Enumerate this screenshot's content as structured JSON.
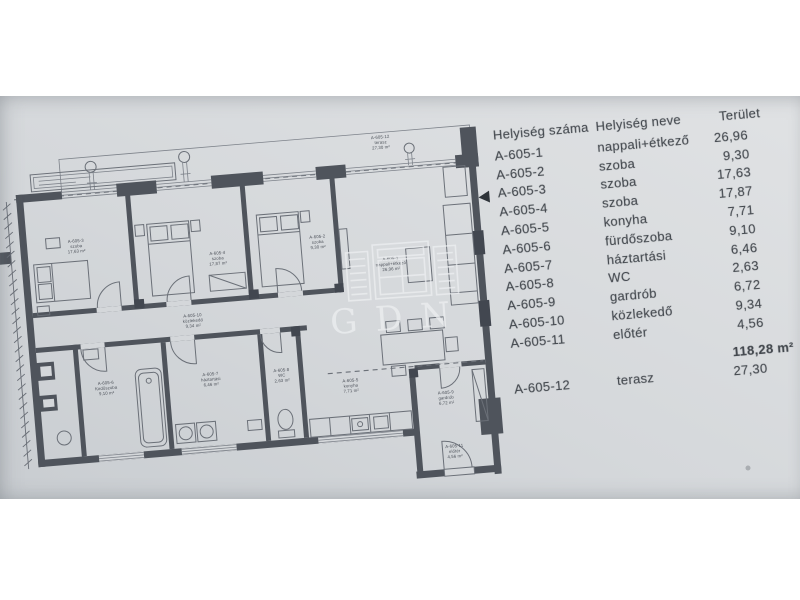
{
  "watermark": {
    "text": "GDN"
  },
  "colors": {
    "paper": "#d4d7da",
    "wall": "#4f545c",
    "line": "#6f747b",
    "text": "#42474d",
    "watermark": "#eef0f2"
  },
  "table": {
    "headers": {
      "number": "Helyiség száma",
      "name": "Helyiség neve",
      "area": "Terület"
    },
    "rows": [
      {
        "number": "A-605-1",
        "name": "nappali+étkező",
        "area": "26,96"
      },
      {
        "number": "A-605-2",
        "name": "szoba",
        "area": "9,30"
      },
      {
        "number": "A-605-3",
        "name": "szoba",
        "area": "17,63"
      },
      {
        "number": "A-605-4",
        "name": "szoba",
        "area": "17,87"
      },
      {
        "number": "A-605-5",
        "name": "konyha",
        "area": "7,71"
      },
      {
        "number": "A-605-6",
        "name": "fürdőszoba",
        "area": "9,10"
      },
      {
        "number": "A-605-7",
        "name": "háztartási",
        "area": "6,46"
      },
      {
        "number": "A-605-8",
        "name": "WC",
        "area": "2,63"
      },
      {
        "number": "A-605-9",
        "name": "gardrób",
        "area": "6,72"
      },
      {
        "number": "A-605-10",
        "name": "közlekedő",
        "area": "9,34"
      },
      {
        "number": "A-605-11",
        "name": "előtér",
        "area": "4,56"
      }
    ],
    "total": {
      "number": "",
      "name": "",
      "area": "118,28 m²"
    },
    "terrace_row": {
      "number": "A-605-12",
      "name": "terasz",
      "area": "27,30"
    }
  },
  "plan": {
    "rooms": [
      {
        "n": "A-605-1",
        "t": "nappali+étkező",
        "a": "26,96 m²",
        "x": 352,
        "y": 140
      },
      {
        "n": "A-605-2",
        "t": "szoba",
        "a": "9,30 m²",
        "x": 281,
        "y": 112
      },
      {
        "n": "A-605-3",
        "t": "szoba",
        "a": "17,63 m²",
        "x": 40,
        "y": 96
      },
      {
        "n": "A-605-4",
        "t": "szoba",
        "a": "17,87 m²",
        "x": 180,
        "y": 120
      },
      {
        "n": "A-605-5",
        "t": "konyha",
        "a": "7,71 m²",
        "x": 302,
        "y": 258
      },
      {
        "n": "A-605-6",
        "t": "fürdőszoba",
        "a": "9,10 m²",
        "x": 58,
        "y": 240
      },
      {
        "n": "A-605-7",
        "t": "háztartási",
        "a": "6,46 m²",
        "x": 163,
        "y": 240
      },
      {
        "n": "A-605-8",
        "t": "WC",
        "a": "2,63 m²",
        "x": 234,
        "y": 242
      },
      {
        "n": "A-605-9",
        "t": "gardrób",
        "a": "6,72 m²",
        "x": 396,
        "y": 278
      },
      {
        "n": "A-605-10",
        "t": "közlekedő",
        "a": "9,34 m²",
        "x": 150,
        "y": 180
      },
      {
        "n": "A-605-11",
        "t": "előtér",
        "a": "4,56 m²",
        "x": 400,
        "y": 332
      }
    ],
    "terrace": {
      "n": "A-605-12",
      "t": "terasz",
      "a": "27,30 m²",
      "x": 352,
      "y": 18
    }
  }
}
